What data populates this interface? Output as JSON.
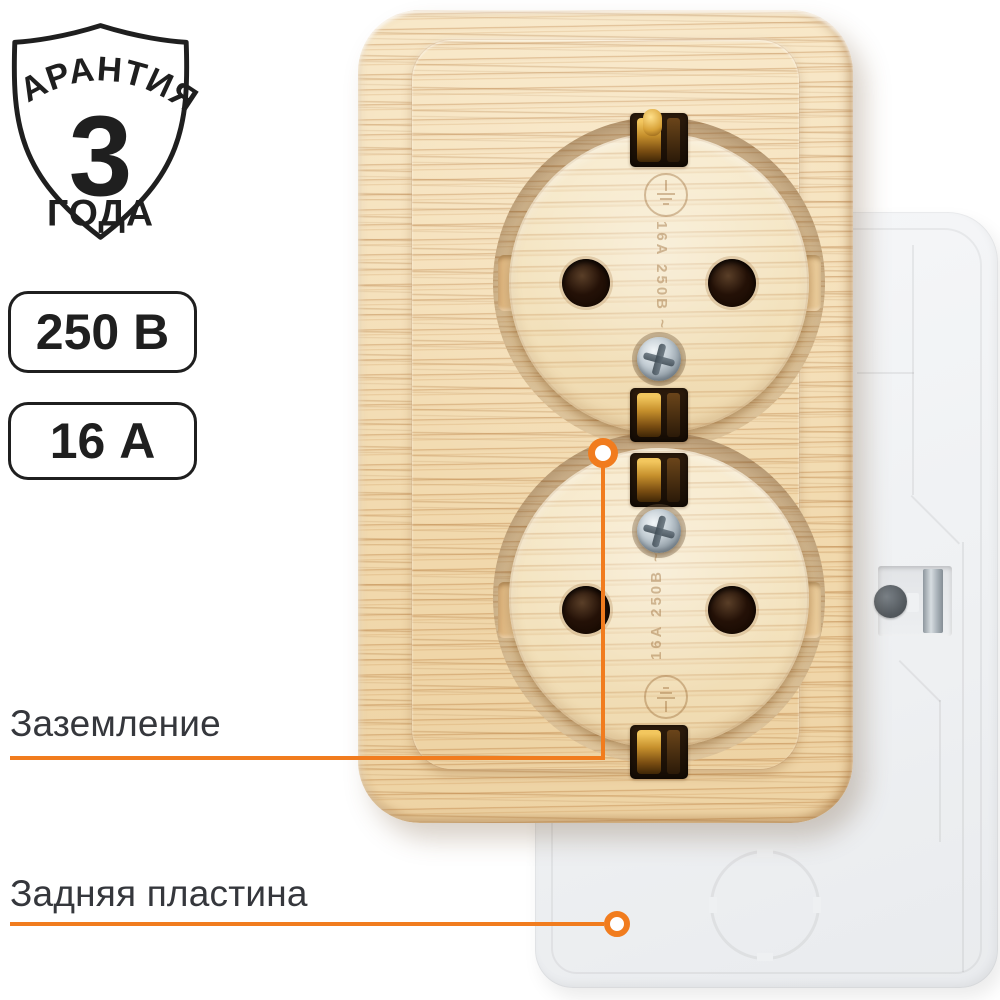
{
  "colors": {
    "accent": "#f17c1e",
    "ink": "#1f1f1f",
    "label": "#35373c"
  },
  "warranty_badge": {
    "top": "ГАРАНТИЯ",
    "value": "3",
    "bottom": "ГОДА"
  },
  "spec_badges": {
    "voltage": "250 В",
    "current": "16 А"
  },
  "callouts": {
    "grounding": "Заземление",
    "back_plate": "Задняя пластина"
  },
  "socket": {
    "embossed_rating": "16A 250B ~"
  }
}
